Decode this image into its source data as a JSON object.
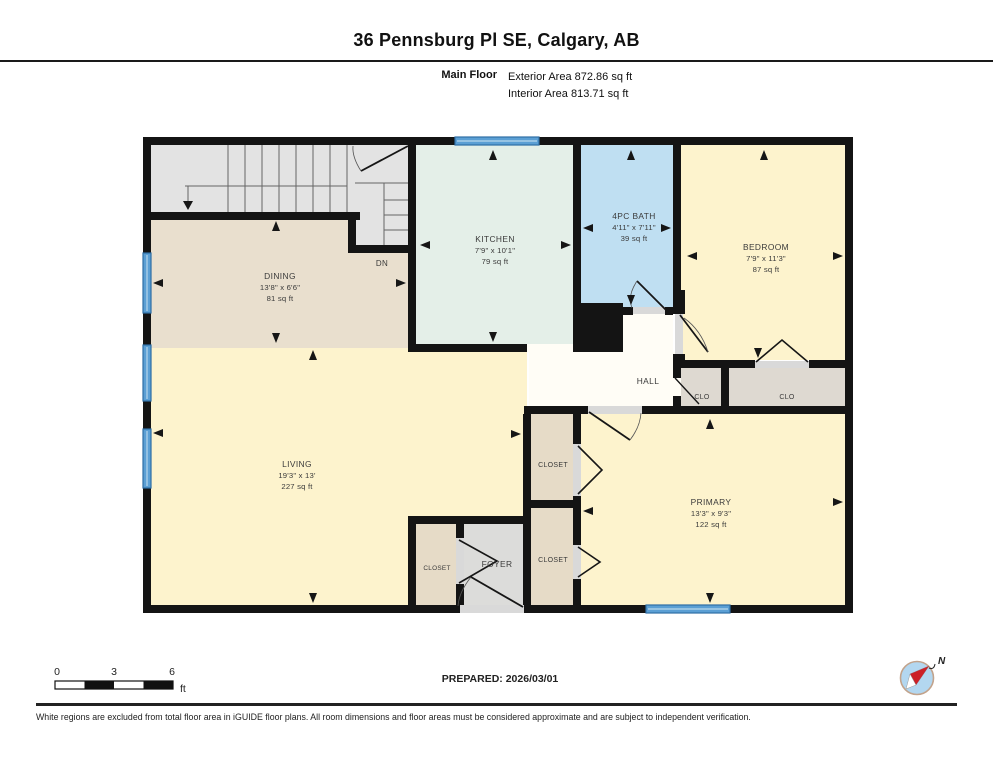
{
  "header": {
    "title": "36 Pennsburg Pl SE, Calgary, AB",
    "floor_label": "Main Floor",
    "exterior_area": "Exterior Area 872.86 sq ft",
    "interior_area": "Interior Area 813.71 sq ft"
  },
  "rooms": {
    "dining": {
      "name": "DINING",
      "dims": "13'8\" x 6'6\"",
      "area": "81 sq ft"
    },
    "kitchen": {
      "name": "KITCHEN",
      "dims": "7'9\" x 10'1\"",
      "area": "79 sq ft"
    },
    "bath": {
      "name": "4PC BATH",
      "dims": "4'11\" x 7'11\"",
      "area": "39 sq ft"
    },
    "bedroom": {
      "name": "BEDROOM",
      "dims": "7'9\" x 11'3\"",
      "area": "87 sq ft"
    },
    "living": {
      "name": "LIVING",
      "dims": "19'3\" x 13'",
      "area": "227 sq ft"
    },
    "primary": {
      "name": "PRIMARY",
      "dims": "13'3\" x 9'3\"",
      "area": "122 sq ft"
    },
    "hall": {
      "name": "HALL"
    },
    "foyer": {
      "name": "FOYER"
    },
    "closet_hall": {
      "name": "CLO"
    },
    "closet_bedroom": {
      "name": "CLO"
    },
    "closet_primary_upper": {
      "name": "CLOSET"
    },
    "closet_primary_lower": {
      "name": "CLOSET"
    },
    "closet_foyer": {
      "name": "CLOSET"
    },
    "stairs_dn": {
      "name": "DN"
    }
  },
  "scale_bar": {
    "tick_start": "0",
    "tick_mid": "3",
    "tick_end": "6",
    "unit": "ft"
  },
  "prepared_label": "PREPARED: 2026/03/01",
  "compass_label": "N",
  "footer_note": "White regions are excluded from total floor area in iGUIDE floor plans. All room dimensions and floor areas must be considered approximate and are subject to independent verification.",
  "colors": {
    "wall": "#141414",
    "dining": "#e9dfce",
    "kitchen": "#e4efe8",
    "bath": "#bfdff2",
    "bedroom": "#fdf3cd",
    "hall": "#fffdf6",
    "closet_gray": "#ded9d1",
    "closet_tan": "#e6dbc7",
    "foyer": "#dcdcda",
    "stairs": "#e3e3e3",
    "window": "#5b9fd4",
    "window_edge": "#2f6ea5",
    "door_sill": "#d9d9d9"
  }
}
